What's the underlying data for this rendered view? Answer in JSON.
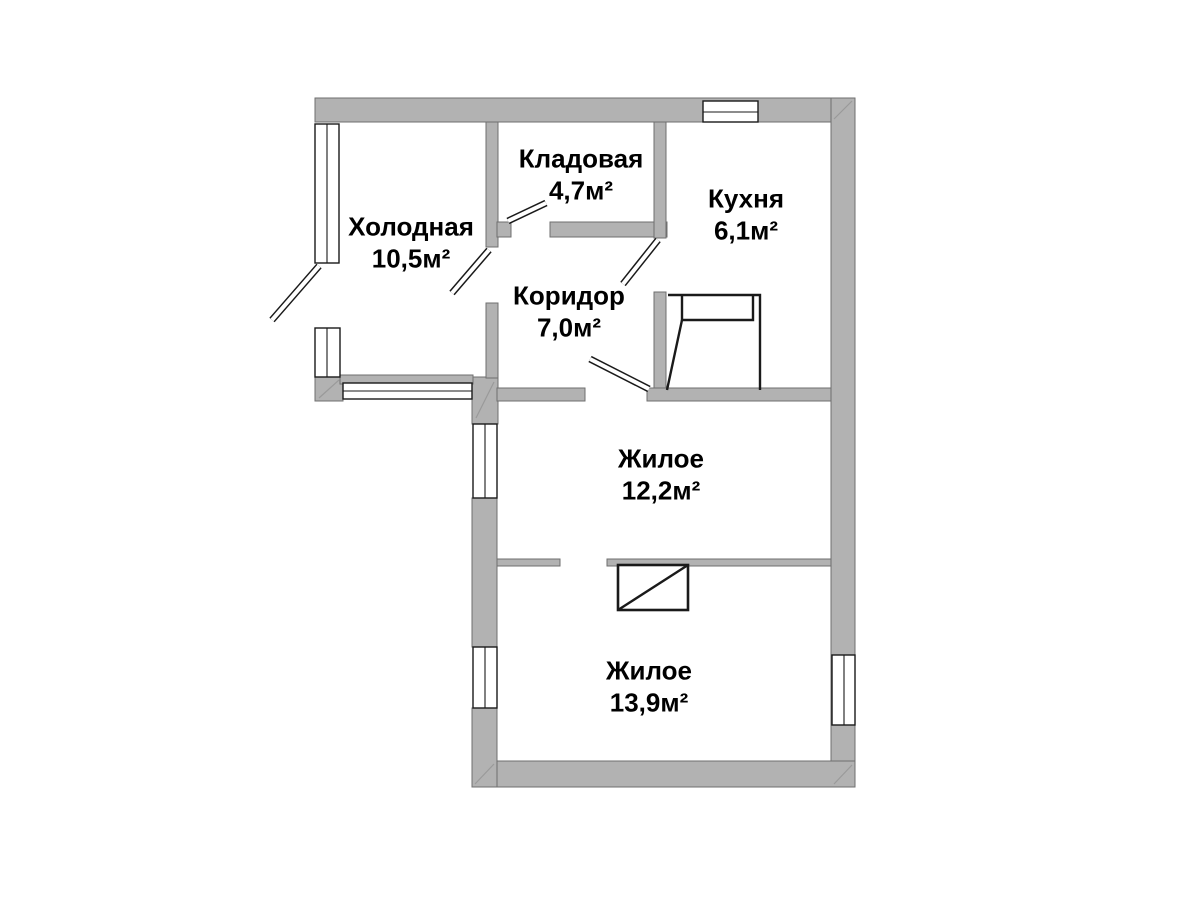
{
  "plan": {
    "rooms": [
      {
        "name": "Холодная",
        "area": "10,5м²"
      },
      {
        "name": "Кладовая",
        "area": "4,7м²"
      },
      {
        "name": "Кухня",
        "area": "6,1м²"
      },
      {
        "name": "Коридор",
        "area": "7,0м²"
      },
      {
        "name": "Жилое",
        "area": "12,2м²"
      },
      {
        "name": "Жилое",
        "area": "13,9м²"
      }
    ],
    "colors": {
      "wall": "#b2b2b2",
      "wall_outline": "#6f6f6f",
      "line": "#1a1a1a",
      "hatch": "#9a9a9a",
      "background": "#ffffff",
      "text": "#000000"
    }
  }
}
